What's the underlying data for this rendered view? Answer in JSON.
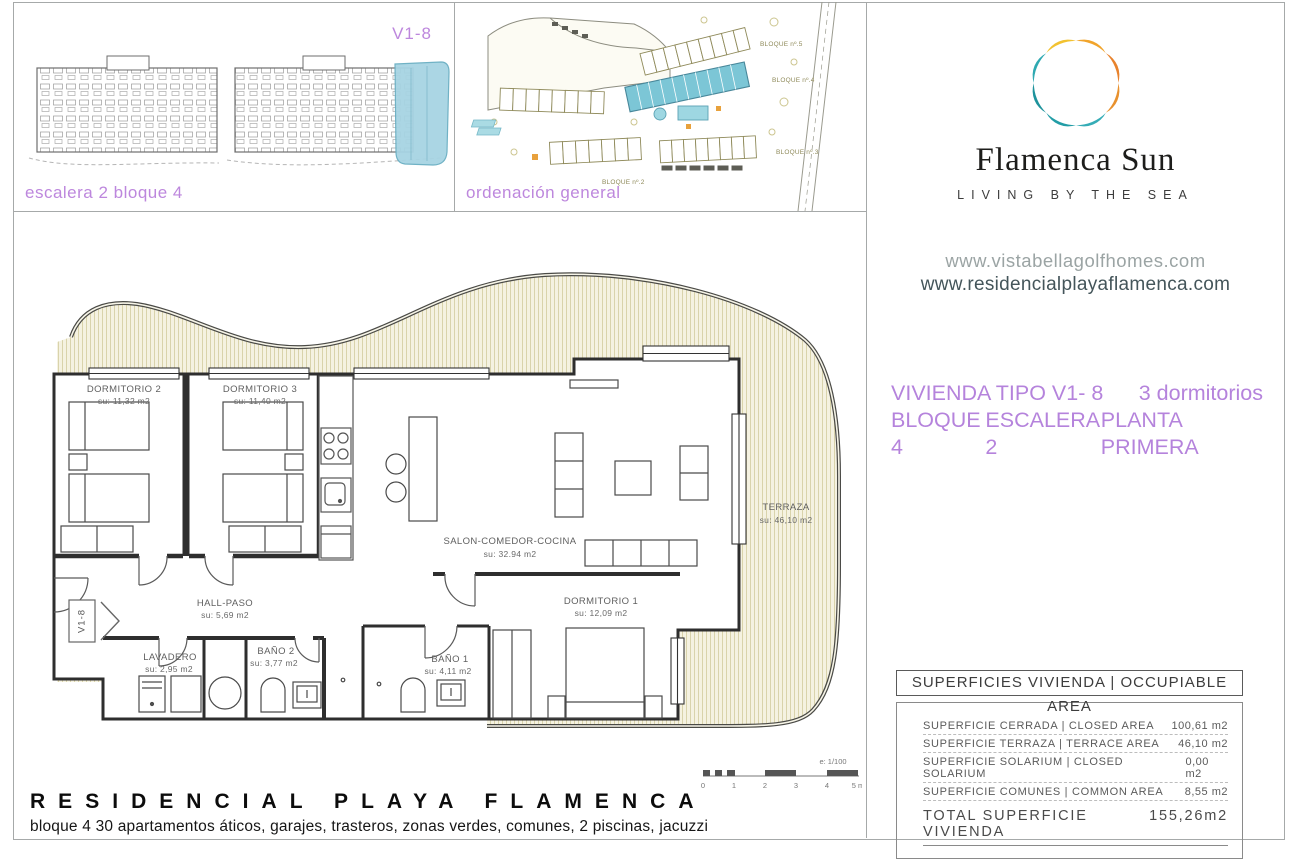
{
  "elevation_panel": {
    "unit_code": "V1-8",
    "caption": "escalera 2 bloque 4"
  },
  "site_panel": {
    "caption": "ordenación general",
    "blocks": {
      "b5": "BLOQUE nº.5",
      "b4": "BLOQUE nº.4",
      "b3": "BLOQUE nº.3",
      "b2": "BLOQUE nº.2"
    }
  },
  "brand": {
    "name": "Flamenca Sun",
    "tagline": "LIVING BY THE SEA",
    "url1": "www.vistabellagolfhomes.com",
    "url2": "www.residencialplayaflamenca.com",
    "logo_colors": [
      "#F1A42B",
      "#E8822C",
      "#E8912E",
      "#35ACB6",
      "#229DA6",
      "#1E939C",
      "#2FA9B1",
      "#F2C230"
    ]
  },
  "unit_header": {
    "line1_left": "VIVIENDA TIPO V1- 8",
    "line1_right": "3 dormitorios",
    "line2_a": "BLOQUE 4",
    "line2_b": "ESCALERA 2",
    "line2_c": "PLANTA PRIMERA",
    "accent": "#b583dc"
  },
  "plan": {
    "marker": "V1-8",
    "rooms": {
      "dorm2": {
        "name": "DORMITORIO 2",
        "area": "su: 11,32 m2"
      },
      "dorm3": {
        "name": "DORMITORIO 3",
        "area": "su: 11,40 m2"
      },
      "salon": {
        "name": "SALON-COMEDOR-COCINA",
        "area": "su: 32.94 m2"
      },
      "dorm1": {
        "name": "DORMITORIO 1",
        "area": "su: 12,09 m2"
      },
      "hall": {
        "name": "HALL-PASO",
        "area": "su: 5,69 m2"
      },
      "lavadero": {
        "name": "LAVADERO",
        "area": "su: 2,95 m2"
      },
      "bano2": {
        "name": "BAÑO 2",
        "area": "su: 3,77 m2"
      },
      "bano1": {
        "name": "BAÑO 1",
        "area": "su: 4,11 m2"
      },
      "terraza": {
        "name": "TERRAZA",
        "area": "su: 46,10 m2"
      }
    },
    "scale": {
      "label": "e: 1/100",
      "t0": "0",
      "t1": "1",
      "t2": "2",
      "t3": "3",
      "t4": "4",
      "t5": "5 m"
    }
  },
  "areas_table": {
    "title": "SUPERFICIES VIVIENDA | OCCUPIABLE AREA",
    "rows": [
      {
        "label": "SUPERFICIE CERRADA | CLOSED AREA",
        "value": "100,61 m2"
      },
      {
        "label": "SUPERFICIE TERRAZA  | TERRACE AREA",
        "value": "46,10 m2"
      },
      {
        "label": "SUPERFICIE SOLARIUM | CLOSED SOLARIUM",
        "value": "0,00 m2"
      },
      {
        "label": "SUPERFICIE COMUNES | COMMON AREA",
        "value": "8,55 m2"
      }
    ],
    "total_label": "TOTAL SUPERFICIE VIVIENDA",
    "total_value": "155,26m2"
  },
  "footer": {
    "title": "RESIDENCIAL PLAYA FLAMENCA",
    "subtitle": "bloque 4 30 apartamentos áticos, garajes, trasteros, zonas verdes, comunes, 2 piscinas, jacuzzi"
  }
}
